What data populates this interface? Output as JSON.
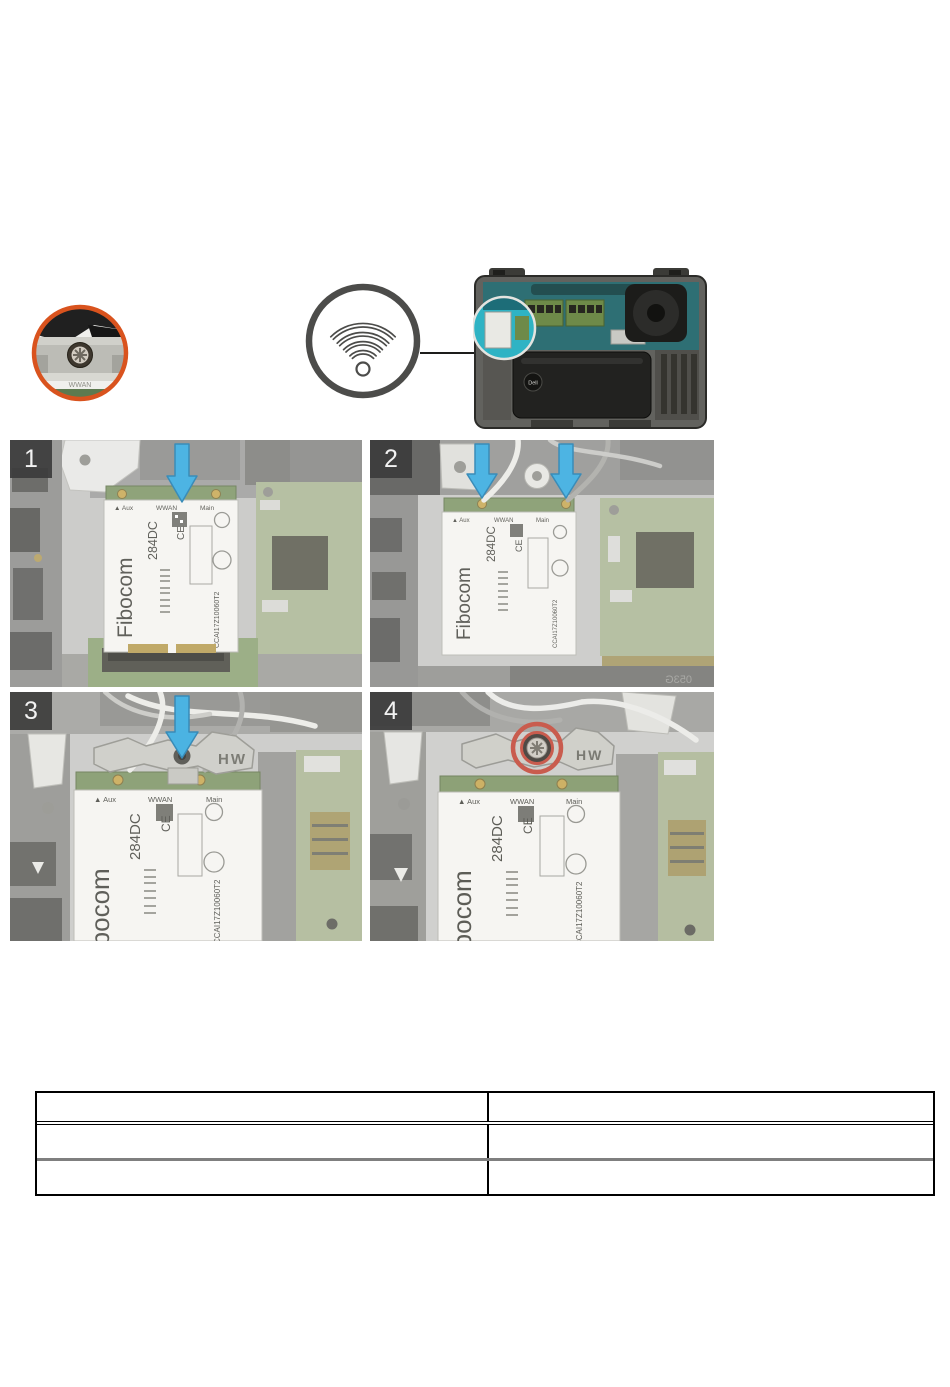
{
  "callout": {
    "label": "WWAN"
  },
  "steps": [
    {
      "number": "1"
    },
    {
      "number": "2"
    },
    {
      "number": "3"
    },
    {
      "number": "4"
    }
  ],
  "wwan_card": {
    "brand": "Fibocom",
    "model": "284DC",
    "serial": "CCAI17Z10060T2",
    "ce_mark": "CE",
    "aux_label": "▲ Aux",
    "wwan_label": "WWAN",
    "main_label": "Main"
  },
  "bracket": {
    "label": "HW"
  },
  "laptop_photo": {
    "battery_label": "Dell",
    "pcb_marking": "053G"
  },
  "table": {
    "rows": [
      [
        "",
        ""
      ],
      [
        "",
        ""
      ],
      [
        "",
        ""
      ]
    ]
  },
  "colors": {
    "highlight_orange": "#d9531e",
    "arrow_blue": "#2ea7de",
    "screw_highlight_red": "#c14434",
    "wifi_ring_gray": "#4c4c4a",
    "wwan_slot_teal": "#2fb3c4"
  }
}
